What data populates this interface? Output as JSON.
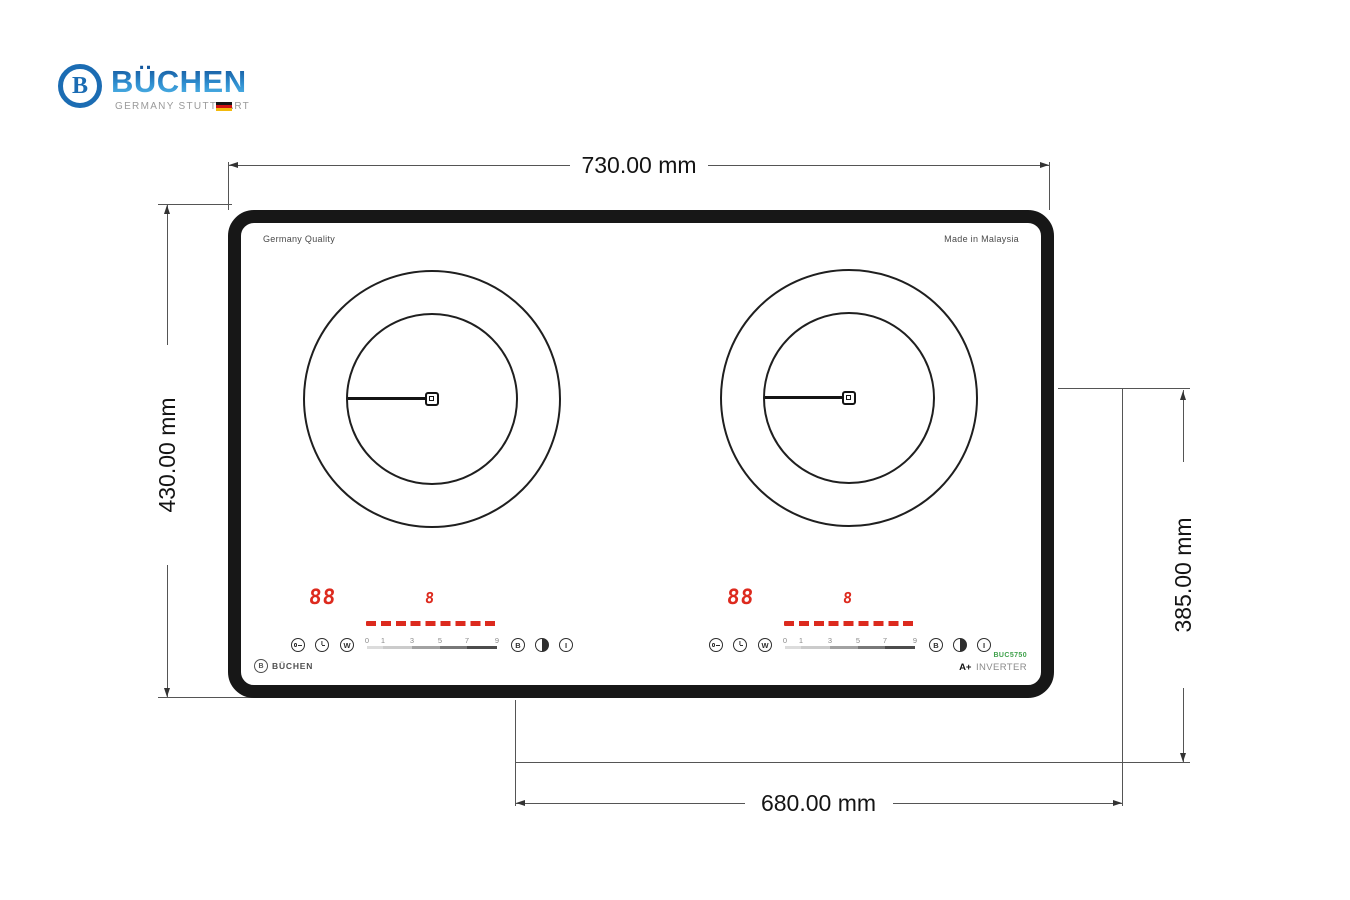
{
  "brand": {
    "logo_letter": "B",
    "name": "BÜCHEN",
    "tagline": "GERMANY STUTTGART"
  },
  "dimensions": {
    "overall_width": "730.00 mm",
    "overall_depth": "430.00 mm",
    "cutout_depth": "385.00 mm",
    "cutout_width": "680.00 mm"
  },
  "cooktop": {
    "quality_label": "Germany Quality",
    "origin_label": "Made in Malaysia",
    "brand_label": "BÜCHEN",
    "brand_logo_letter": "B",
    "model": "BUC5750",
    "energy_class": "A+",
    "inverter_label": "INVERTER"
  },
  "controls": {
    "power_display": "88",
    "level_display": "8",
    "scale": [
      "0",
      "1",
      "3",
      "5",
      "7",
      "9"
    ],
    "buttons": {
      "wok": "W",
      "booster": "B",
      "power": "I"
    }
  },
  "colors": {
    "accent_red": "#dd2a1e",
    "brand_blue": "#1b6cb3",
    "model_green": "#3fa14b"
  }
}
